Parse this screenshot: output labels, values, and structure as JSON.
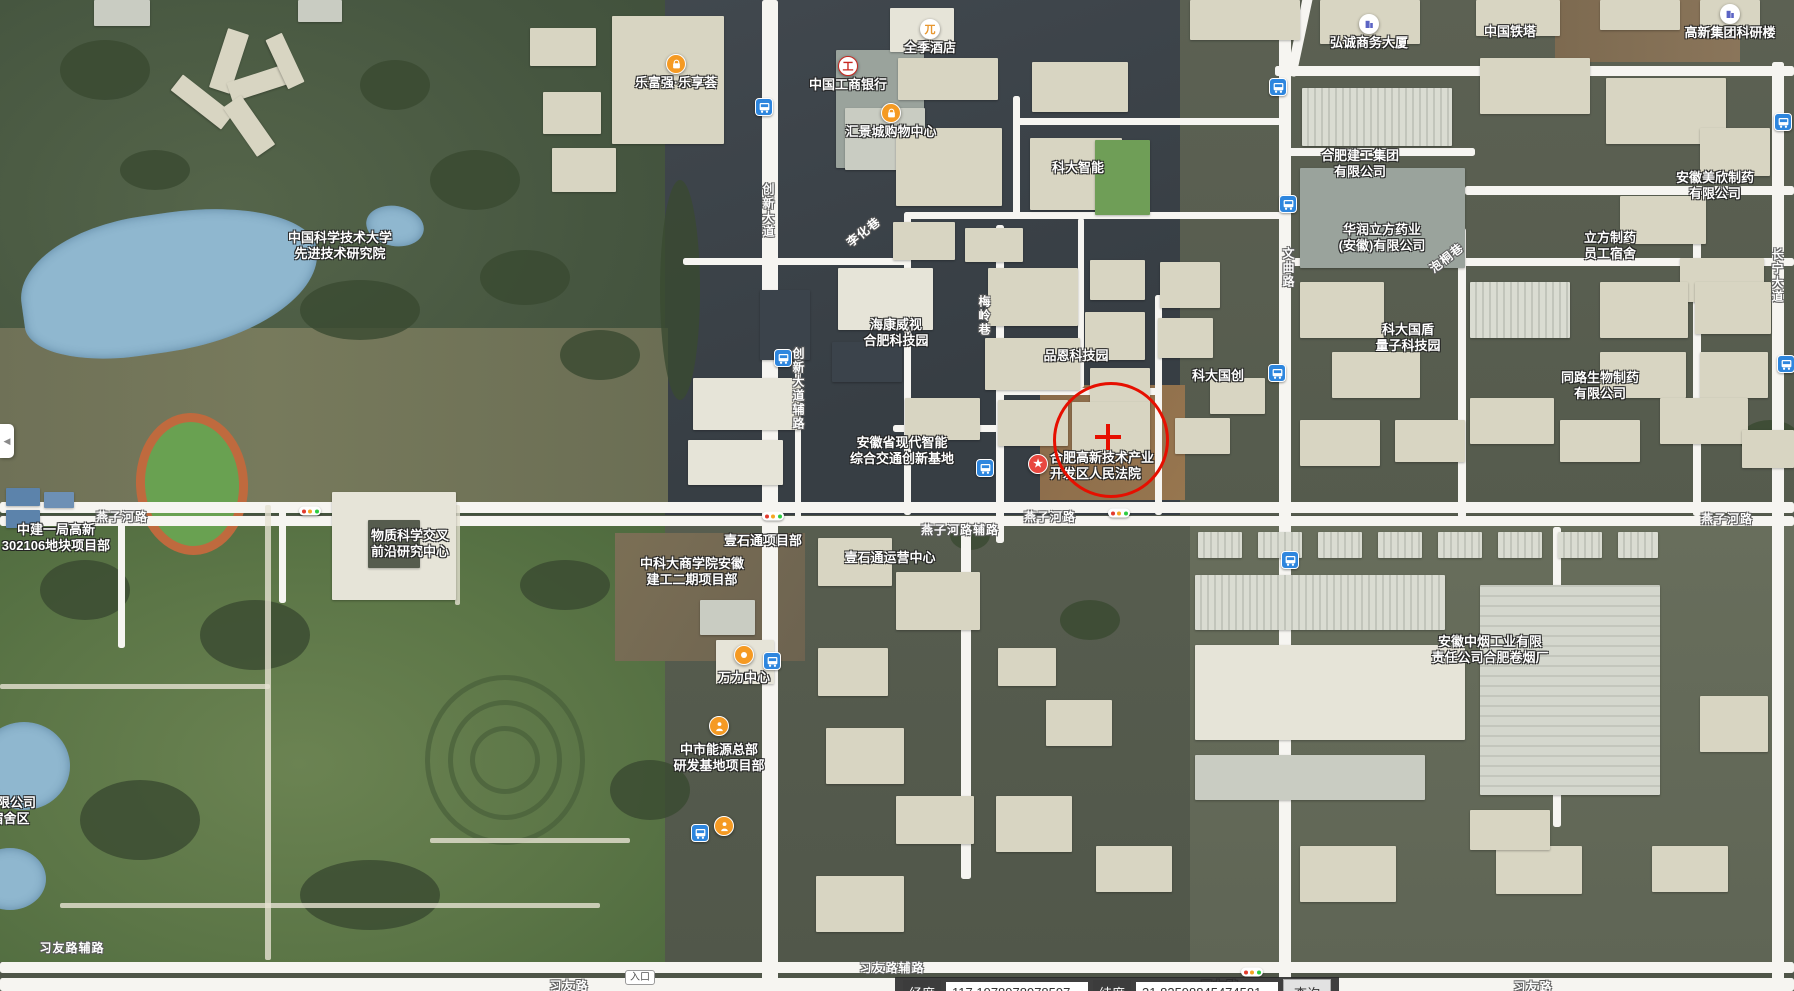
{
  "map": {
    "colors": {
      "road": "#f6f5f1",
      "marker_red": "#e60f00",
      "bus_blue": "#2e86de",
      "poi_orange": "#f59a23",
      "star_red": "#e8473f",
      "water": "#8fb7cf"
    },
    "poi_markers": [
      {
        "icon": "shopping-bag-icon",
        "x": 676,
        "y": 64,
        "lines": [
          "乐富强·乐享荟"
        ]
      },
      {
        "icon": "bank-icon",
        "x": 848,
        "y": 66,
        "lines": [
          "中国工商银行"
        ]
      },
      {
        "icon": "hotel-icon",
        "x": 930,
        "y": 29,
        "lines": [
          "全季酒店"
        ]
      },
      {
        "icon": "shopping-bag-icon",
        "x": 891,
        "y": 113,
        "lines": [
          "汇景城购物中心"
        ]
      },
      {
        "icon": "building-icon",
        "x": 1369,
        "y": 24,
        "lines": [
          "弘诚商务大厦"
        ]
      },
      {
        "icon": "building-icon",
        "x": 1730,
        "y": 14,
        "lines": [
          "高新集团科研楼"
        ]
      },
      {
        "icon": "star-icon",
        "x": 1038,
        "y": 464,
        "side": "right",
        "lines": [
          "合肥高新技术产业",
          "开发区人民法院"
        ]
      },
      {
        "icon": "worker-icon",
        "x": 719,
        "y": 726,
        "lines": []
      },
      {
        "icon": "worker-icon",
        "x": 724,
        "y": 826,
        "lines": []
      },
      {
        "icon": "dot-icon",
        "x": 744,
        "y": 655,
        "lines": []
      }
    ],
    "place_labels": [
      {
        "x": 340,
        "y": 230,
        "lines": [
          "中国科学技术大学",
          "先进技术研究院"
        ]
      },
      {
        "x": 1078,
        "y": 160,
        "lines": [
          "科大智能"
        ]
      },
      {
        "x": 1510,
        "y": 24,
        "lines": [
          "中国铁塔"
        ]
      },
      {
        "x": 1360,
        "y": 148,
        "lines": [
          "合肥建工集团",
          "有限公司"
        ]
      },
      {
        "x": 1382,
        "y": 222,
        "lines": [
          "华润立方药业",
          "(安徽)有限公司"
        ]
      },
      {
        "x": 1715,
        "y": 170,
        "lines": [
          "安徽美欣制药",
          "有限公司"
        ]
      },
      {
        "x": 1610,
        "y": 230,
        "lines": [
          "立方制药",
          "员工宿舍"
        ]
      },
      {
        "x": 1600,
        "y": 370,
        "lines": [
          "同路生物制药",
          "有限公司"
        ]
      },
      {
        "x": 896,
        "y": 317,
        "lines": [
          "海康威视",
          "合肥科技园"
        ]
      },
      {
        "x": 1076,
        "y": 348,
        "lines": [
          "品恩科技园"
        ]
      },
      {
        "x": 1218,
        "y": 368,
        "lines": [
          "科大国创"
        ]
      },
      {
        "x": 1408,
        "y": 322,
        "lines": [
          "科大国盾",
          "量子科技园"
        ]
      },
      {
        "x": 902,
        "y": 435,
        "lines": [
          "安徽省现代智能",
          "综合交通创新基地"
        ]
      },
      {
        "x": 410,
        "y": 528,
        "lines": [
          "物质科学交叉",
          "前沿研究中心"
        ]
      },
      {
        "x": 56,
        "y": 522,
        "lines": [
          "中建一局高新",
          "302106地块项目部"
        ]
      },
      {
        "x": 692,
        "y": 556,
        "lines": [
          "中科大商学院安徽",
          "建工二期项目部"
        ]
      },
      {
        "x": 763,
        "y": 533,
        "lines": [
          "壹石通项目部"
        ]
      },
      {
        "x": 890,
        "y": 550,
        "lines": [
          "壹石通运营中心"
        ]
      },
      {
        "x": 1490,
        "y": 634,
        "lines": [
          "安徽中烟工业有限",
          "责任公司合肥卷烟厂"
        ]
      },
      {
        "x": 10,
        "y": 795,
        "lines": [
          "有限公司",
          "宿舍区"
        ]
      },
      {
        "x": 744,
        "y": 670,
        "lines": [
          "万力中心"
        ]
      },
      {
        "x": 719,
        "y": 742,
        "lines": [
          "中市能源总部",
          "研发基地项目部"
        ]
      }
    ],
    "road_labels": [
      {
        "text": "燕子河路",
        "x": 122,
        "y": 511
      },
      {
        "text": "燕子河路",
        "x": 1050,
        "y": 511
      },
      {
        "text": "燕子河路",
        "x": 1727,
        "y": 513
      },
      {
        "text": "燕子河路辅路",
        "x": 960,
        "y": 524
      },
      {
        "text": "习友路辅路",
        "x": 72,
        "y": 942
      },
      {
        "text": "习友路辅路",
        "x": 892,
        "y": 962
      },
      {
        "text": "习友路",
        "x": 569,
        "y": 980
      },
      {
        "text": "习友路",
        "x": 1220,
        "y": 980
      },
      {
        "text": "习友路",
        "x": 1533,
        "y": 981
      },
      {
        "text": "创新大道",
        "x": 761,
        "y": 183,
        "vertical": true
      },
      {
        "text": "创新大道辅路",
        "x": 791,
        "y": 347,
        "vertical": true
      },
      {
        "text": "文曲路",
        "x": 1281,
        "y": 247,
        "vertical": true
      },
      {
        "text": "梅岭巷",
        "x": 977,
        "y": 295,
        "vertical": true
      },
      {
        "text": "长宁大道",
        "x": 1770,
        "y": 248,
        "vertical": true
      },
      {
        "text": "李化巷",
        "x": 864,
        "y": 226,
        "rotate": true
      },
      {
        "text": "泡桐巷",
        "x": 1447,
        "y": 252,
        "rotate": true
      }
    ],
    "bus_stops": [
      {
        "x": 764,
        "y": 107
      },
      {
        "x": 1278,
        "y": 87
      },
      {
        "x": 1783,
        "y": 122
      },
      {
        "x": 1288,
        "y": 204
      },
      {
        "x": 783,
        "y": 358
      },
      {
        "x": 1277,
        "y": 373
      },
      {
        "x": 1786,
        "y": 364
      },
      {
        "x": 985,
        "y": 468
      },
      {
        "x": 1290,
        "y": 560
      },
      {
        "x": 772,
        "y": 661
      },
      {
        "x": 700,
        "y": 833
      }
    ],
    "traffic_lights": [
      {
        "x": 310,
        "y": 511
      },
      {
        "x": 773,
        "y": 516
      },
      {
        "x": 1119,
        "y": 513
      },
      {
        "x": 1252,
        "y": 972
      }
    ],
    "marker": {
      "x": 1108,
      "y": 437,
      "radius": 55
    },
    "entrance_badge": {
      "text": "入口",
      "x": 640,
      "y": 970
    }
  },
  "controls": {
    "collapse_arrow": "◀"
  },
  "statusbar": {
    "lon_label": "经度",
    "lon_value": "117.1978978978597",
    "lat_label": "纬度",
    "lat_value": "31.83598845474581",
    "search_label": "查询"
  }
}
